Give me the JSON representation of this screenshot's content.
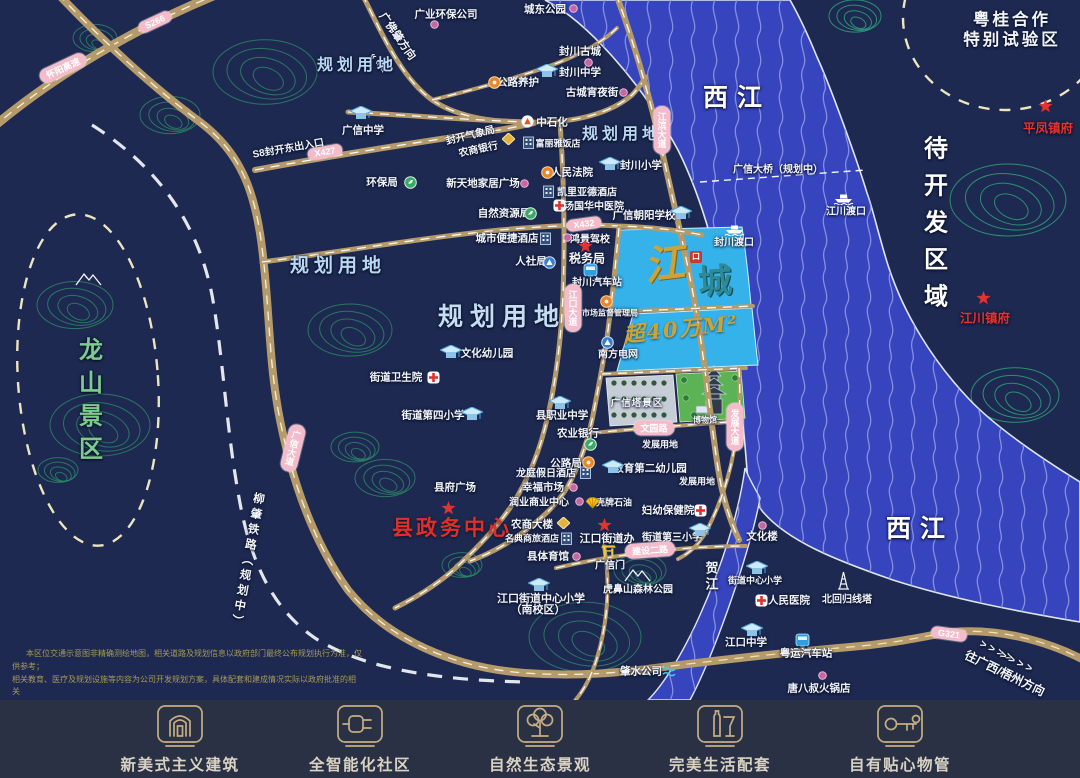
{
  "colors": {
    "bg": "#1d2950",
    "river": "#3644bd",
    "wave": "#8d98e2",
    "parcel": "#35b2ea",
    "road": "#b59a6c",
    "pill": "#f4bcca",
    "contour": "#2d8a66",
    "red": "#e02f2b",
    "gold": "#c9a43d",
    "footer_bg": "#2b3144",
    "footer_gold": "#c6ae83"
  },
  "map": {
    "logo": {
      "jiang": "江",
      "kou": "口",
      "cheng": "城"
    },
    "labels": [
      {
        "t": "广业环保公司",
        "x": 446,
        "y": 14,
        "c": "w"
      },
      {
        "t": "城东公园",
        "x": 545,
        "y": 9,
        "c": "w"
      },
      {
        "t": "封川古城",
        "x": 580,
        "y": 51,
        "c": "w"
      },
      {
        "t": "封川中学",
        "x": 580,
        "y": 72,
        "c": "w"
      },
      {
        "t": "古城宵夜街",
        "x": 592,
        "y": 92,
        "c": "w"
      },
      {
        "t": "公路养护",
        "x": 518,
        "y": 82,
        "c": "w"
      },
      {
        "t": "中石化",
        "x": 552,
        "y": 122,
        "c": "w"
      },
      {
        "t": "广佛肇方向",
        "x": 398,
        "y": 36,
        "c": "w11",
        "r": 55
      },
      {
        "t": "« « «",
        "x": 378,
        "y": 63,
        "c": "w10",
        "r": 55
      },
      {
        "t": "规划用地",
        "x": 357,
        "y": 63,
        "c": "plan17"
      },
      {
        "t": "规划用地",
        "x": 622,
        "y": 132,
        "c": "plan17"
      },
      {
        "t": "规划用地",
        "x": 338,
        "y": 264,
        "c": "plan19"
      },
      {
        "t": "规划用地",
        "x": 502,
        "y": 315,
        "c": "plan26"
      },
      {
        "t": "广信中学",
        "x": 363,
        "y": 130,
        "c": "w"
      },
      {
        "t": "封开气象局",
        "x": 470,
        "y": 134,
        "c": "w10",
        "r": -14
      },
      {
        "t": "农商银行",
        "x": 478,
        "y": 148,
        "c": "w10",
        "r": -12
      },
      {
        "t": "环保局",
        "x": 382,
        "y": 182,
        "c": "w"
      },
      {
        "t": "新天地家居广场",
        "x": 483,
        "y": 183,
        "c": "w"
      },
      {
        "t": "人民法院",
        "x": 572,
        "y": 172,
        "c": "w"
      },
      {
        "t": "富丽雅饭店",
        "x": 558,
        "y": 143,
        "c": "w9"
      },
      {
        "t": "凯里亚德酒店",
        "x": 587,
        "y": 191,
        "c": "w10"
      },
      {
        "t": "汤国华中医院",
        "x": 594,
        "y": 205,
        "c": "w10"
      },
      {
        "t": "广信朝阳学校",
        "x": 644,
        "y": 215,
        "c": "w"
      },
      {
        "t": "封川小学",
        "x": 641,
        "y": 165,
        "c": "w"
      },
      {
        "t": "自然资源局",
        "x": 504,
        "y": 213,
        "c": "w"
      },
      {
        "t": "城市便捷酒店",
        "x": 507,
        "y": 238,
        "c": "w"
      },
      {
        "t": "鸿景驾校",
        "x": 590,
        "y": 238,
        "c": "w10"
      },
      {
        "t": "税务局",
        "x": 587,
        "y": 258,
        "c": "wb12"
      },
      {
        "t": "人社局",
        "x": 531,
        "y": 261,
        "c": "w"
      },
      {
        "t": "封川汽车站",
        "x": 597,
        "y": 281,
        "c": "w10"
      },
      {
        "t": "市场监督管理局",
        "x": 610,
        "y": 313,
        "c": "w8"
      },
      {
        "t": "南方电网",
        "x": 618,
        "y": 353,
        "c": "w10"
      },
      {
        "t": "超40万M²",
        "x": 681,
        "y": 328,
        "c": "gold20",
        "r": -6
      },
      {
        "t": "文化幼儿园",
        "x": 487,
        "y": 353,
        "c": "w"
      },
      {
        "t": "街道卫生院",
        "x": 396,
        "y": 377,
        "c": "w"
      },
      {
        "t": "街道第四小学",
        "x": 433,
        "y": 415,
        "c": "w"
      },
      {
        "t": "县职业中学",
        "x": 562,
        "y": 415,
        "c": "w"
      },
      {
        "t": "农业银行",
        "x": 578,
        "y": 433,
        "c": "w"
      },
      {
        "t": "公路局",
        "x": 566,
        "y": 463,
        "c": "w"
      },
      {
        "t": "龙庭假日酒店",
        "x": 546,
        "y": 472,
        "c": "w10"
      },
      {
        "t": "幸福市场",
        "x": 543,
        "y": 487,
        "c": "w"
      },
      {
        "t": "润业商业中心",
        "x": 539,
        "y": 501,
        "c": "w10"
      },
      {
        "t": "县府广场",
        "x": 455,
        "y": 487,
        "c": "w"
      },
      {
        "t": "县政务中心",
        "x": 452,
        "y": 527,
        "c": "red21"
      },
      {
        "t": "农商大楼",
        "x": 532,
        "y": 524,
        "c": "w"
      },
      {
        "t": "名典商旅酒店",
        "x": 532,
        "y": 538,
        "c": "w9"
      },
      {
        "t": "县体育馆",
        "x": 548,
        "y": 556,
        "c": "w"
      },
      {
        "t": "江口街道办",
        "x": 607,
        "y": 538,
        "c": "wb11"
      },
      {
        "t": "广信门",
        "x": 610,
        "y": 564,
        "c": "w10"
      },
      {
        "t": "街道第三小学",
        "x": 672,
        "y": 536,
        "c": "w10"
      },
      {
        "t": "虎鼻山森林公园",
        "x": 638,
        "y": 588,
        "c": "w10"
      },
      {
        "t": "江口街道中心小学",
        "x": 541,
        "y": 598,
        "c": "w11"
      },
      {
        "t": "（南校区）",
        "x": 538,
        "y": 609,
        "c": "w11"
      },
      {
        "t": "妇幼保健院",
        "x": 668,
        "y": 510,
        "c": "w"
      },
      {
        "t": "教育第二幼儿园",
        "x": 650,
        "y": 468,
        "c": "w"
      },
      {
        "t": "壳牌石油",
        "x": 614,
        "y": 502,
        "c": "w9"
      },
      {
        "t": "发展用地",
        "x": 660,
        "y": 444,
        "c": "w9"
      },
      {
        "t": "发展用地",
        "x": 697,
        "y": 481,
        "c": "w9"
      },
      {
        "t": "广信塔景区",
        "x": 637,
        "y": 402,
        "c": "park"
      },
      {
        "t": "博物馆",
        "x": 705,
        "y": 420,
        "c": "w8"
      },
      {
        "t": "肇水公司",
        "x": 641,
        "y": 671,
        "c": "w"
      },
      {
        "t": "文化楼",
        "x": 762,
        "y": 536,
        "c": "w"
      },
      {
        "t": "街道中心小学",
        "x": 755,
        "y": 580,
        "c": "w9"
      },
      {
        "t": "人民医院",
        "x": 789,
        "y": 600,
        "c": "w"
      },
      {
        "t": "北回归线塔",
        "x": 847,
        "y": 598,
        "c": "w10"
      },
      {
        "t": "江口中学",
        "x": 746,
        "y": 642,
        "c": "w"
      },
      {
        "t": "粤运汽车站",
        "x": 806,
        "y": 653,
        "c": "w"
      },
      {
        "t": "唐八叔火锅店",
        "x": 819,
        "y": 688,
        "c": "w"
      },
      {
        "t": "平凤镇府",
        "x": 1048,
        "y": 127,
        "c": "red13"
      },
      {
        "t": "江川镇府",
        "x": 985,
        "y": 317,
        "c": "red13"
      },
      {
        "t": "江川渡口",
        "x": 846,
        "y": 210,
        "c": "w10"
      },
      {
        "t": "封川渡口",
        "x": 734,
        "y": 241,
        "c": "w10"
      },
      {
        "t": "广信大桥（规划中）",
        "x": 778,
        "y": 168,
        "c": "w10"
      },
      {
        "t": "S8封开东出入口",
        "x": 288,
        "y": 147,
        "c": "w10",
        "r": -10
      },
      {
        "t": "西江",
        "x": 737,
        "y": 96,
        "c": "big26"
      },
      {
        "t": "西江",
        "x": 920,
        "y": 527,
        "c": "big26"
      },
      {
        "t": "待开发区域",
        "x": 933,
        "y": 228,
        "c": "bigv",
        "v": true
      },
      {
        "t": "粤桂合作",
        "x": 1012,
        "y": 18,
        "c": "wb16"
      },
      {
        "t": "特别试验区",
        "x": 1012,
        "y": 38,
        "c": "wb16"
      },
      {
        "t": "龙山景区",
        "x": 88,
        "y": 403,
        "c": "greenv",
        "v": true
      },
      {
        "t": "柳肇铁路（规划中）",
        "x": 247,
        "y": 561,
        "c": "wv12",
        "r": 10,
        "v": true
      },
      {
        "t": "贺江",
        "x": 711,
        "y": 577,
        "c": "wbv13",
        "v": true
      },
      {
        "t": "往广西/梧州方向",
        "x": 1005,
        "y": 673,
        "c": "w12",
        "r": 26
      },
      {
        "t": "> > > >",
        "x": 996,
        "y": 651,
        "c": "w11",
        "r": 26
      },
      {
        "t": "> > > >",
        "x": 1016,
        "y": 662,
        "c": "w11",
        "r": 26
      }
    ],
    "icons": [
      {
        "k": "dot",
        "x": 434,
        "y": 24
      },
      {
        "k": "dot",
        "x": 573,
        "y": 8
      },
      {
        "k": "dot",
        "x": 588,
        "y": 62
      },
      {
        "k": "dot",
        "x": 623,
        "y": 92
      },
      {
        "k": "dot",
        "x": 524,
        "y": 183
      },
      {
        "k": "dot",
        "x": 567,
        "y": 237
      },
      {
        "k": "dot",
        "x": 573,
        "y": 487
      },
      {
        "k": "dot",
        "x": 579,
        "y": 501
      },
      {
        "k": "dot",
        "x": 576,
        "y": 556
      },
      {
        "k": "dot",
        "x": 762,
        "y": 525
      },
      {
        "k": "dot",
        "x": 822,
        "y": 675
      },
      {
        "k": "school",
        "x": 547,
        "y": 71
      },
      {
        "k": "school",
        "x": 361,
        "y": 113
      },
      {
        "k": "school",
        "x": 681,
        "y": 213
      },
      {
        "k": "school",
        "x": 610,
        "y": 164
      },
      {
        "k": "school",
        "x": 451,
        "y": 352
      },
      {
        "k": "school",
        "x": 472,
        "y": 414
      },
      {
        "k": "school",
        "x": 560,
        "y": 403
      },
      {
        "k": "school",
        "x": 539,
        "y": 585
      },
      {
        "k": "school",
        "x": 700,
        "y": 530
      },
      {
        "k": "school",
        "x": 613,
        "y": 467
      },
      {
        "k": "school",
        "x": 757,
        "y": 568
      },
      {
        "k": "school",
        "x": 752,
        "y": 630
      },
      {
        "k": "cross",
        "x": 559,
        "y": 205
      },
      {
        "k": "cross",
        "x": 433,
        "y": 377
      },
      {
        "k": "cross",
        "x": 700,
        "y": 510
      },
      {
        "k": "cross",
        "x": 761,
        "y": 600
      },
      {
        "k": "star",
        "x": 585,
        "y": 246
      },
      {
        "k": "star",
        "x": 448,
        "y": 508
      },
      {
        "k": "star",
        "x": 604,
        "y": 525
      },
      {
        "k": "star",
        "x": 1045,
        "y": 106
      },
      {
        "k": "star",
        "x": 983,
        "y": 298
      },
      {
        "k": "bus",
        "x": 590,
        "y": 271
      },
      {
        "k": "bus",
        "x": 802,
        "y": 641
      },
      {
        "k": "hotel",
        "x": 528,
        "y": 142
      },
      {
        "k": "hotel",
        "x": 548,
        "y": 191
      },
      {
        "k": "hotel",
        "x": 545,
        "y": 238
      },
      {
        "k": "hotel",
        "x": 585,
        "y": 472
      },
      {
        "k": "hotel",
        "x": 566,
        "y": 538
      },
      {
        "k": "ferry",
        "x": 843,
        "y": 198
      },
      {
        "k": "ferry",
        "x": 734,
        "y": 229
      },
      {
        "k": "cgreen",
        "x": 410,
        "y": 182
      },
      {
        "k": "cgreen",
        "x": 530,
        "y": 213
      },
      {
        "k": "cgreen",
        "x": 590,
        "y": 444
      },
      {
        "k": "corange",
        "x": 494,
        "y": 82
      },
      {
        "k": "corange",
        "x": 547,
        "y": 172
      },
      {
        "k": "corange",
        "x": 606,
        "y": 301
      },
      {
        "k": "corange",
        "x": 588,
        "y": 462
      },
      {
        "k": "cblue",
        "x": 549,
        "y": 262
      },
      {
        "k": "cblue",
        "x": 607,
        "y": 342
      },
      {
        "k": "gold",
        "x": 508,
        "y": 139
      },
      {
        "k": "gold",
        "x": 563,
        "y": 523
      },
      {
        "k": "gate",
        "x": 608,
        "y": 551
      },
      {
        "k": "tower",
        "x": 843,
        "y": 580
      },
      {
        "k": "shell",
        "x": 592,
        "y": 502
      },
      {
        "k": "water",
        "x": 669,
        "y": 671
      },
      {
        "k": "mtn",
        "x": 88,
        "y": 278
      },
      {
        "k": "mtn",
        "x": 637,
        "y": 574
      },
      {
        "k": "pump",
        "x": 527,
        "y": 121
      }
    ],
    "pills": [
      {
        "t": "S266",
        "x": 155,
        "y": 22,
        "r": -25
      },
      {
        "t": "怀阳高速",
        "x": 63,
        "y": 68,
        "r": -25
      },
      {
        "t": "X427",
        "x": 325,
        "y": 152,
        "r": -10
      },
      {
        "t": "X432",
        "x": 584,
        "y": 224,
        "r": -8
      },
      {
        "t": "G321",
        "x": 949,
        "y": 634,
        "r": 8
      },
      {
        "t": "建设二路",
        "x": 650,
        "y": 550,
        "r": -4
      },
      {
        "t": "文园路",
        "x": 654,
        "y": 428,
        "r": 0
      },
      {
        "t": "江滨大道",
        "x": 662,
        "y": 130,
        "r": 0,
        "v": true
      },
      {
        "t": "江口大道",
        "x": 573,
        "y": 308,
        "r": 0,
        "v": true
      },
      {
        "t": "广信大道",
        "x": 293,
        "y": 448,
        "r": 14,
        "v": true
      },
      {
        "t": "发展大道",
        "x": 735,
        "y": 427,
        "r": 0,
        "v": true
      }
    ],
    "hills": [
      [
        265,
        72,
        52,
        0
      ],
      [
        170,
        115,
        30,
        0
      ],
      [
        95,
        38,
        22,
        0
      ],
      [
        855,
        16,
        26,
        1
      ],
      [
        1008,
        200,
        58,
        1
      ],
      [
        1015,
        395,
        44,
        1
      ],
      [
        75,
        305,
        38,
        0
      ],
      [
        100,
        425,
        50,
        0
      ],
      [
        350,
        330,
        42,
        0
      ],
      [
        355,
        447,
        24,
        0
      ],
      [
        462,
        565,
        20,
        0
      ],
      [
        585,
        637,
        56,
        0
      ],
      [
        640,
        570,
        26,
        0
      ],
      [
        385,
        478,
        30,
        0
      ],
      [
        58,
        470,
        20,
        0
      ]
    ]
  },
  "disclaimer": {
    "l1": "本区位交通示意图非精确测绘地图，相关道路及规划信息以政府部门最终公布规划执行为准，仅供参考；",
    "l2": "相关教育、医疗及规划设施等内容为公司开发规划方案，具体配套和建成情况实际以政府批准的相关",
    "l3": "法律文件及商品买卖合同约定为准，开发商保留最终解释权。"
  },
  "footer": {
    "items": [
      {
        "label": "新美式主义建筑",
        "icon": "arch"
      },
      {
        "label": "全智能化社区",
        "icon": "smart"
      },
      {
        "label": "自然生态景观",
        "icon": "tree"
      },
      {
        "label": "完美生活配套",
        "icon": "life"
      },
      {
        "label": "自有贴心物管",
        "icon": "key"
      }
    ]
  }
}
